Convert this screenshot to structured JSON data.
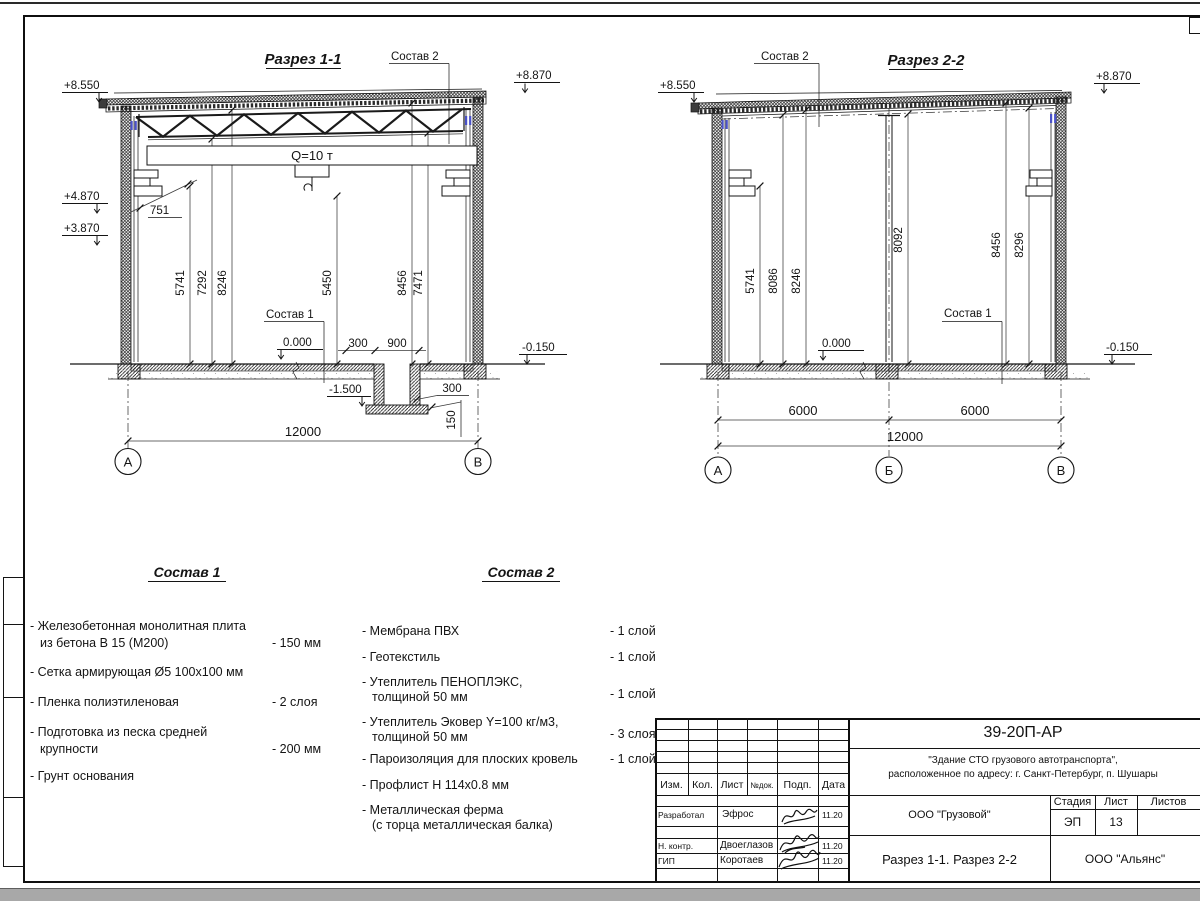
{
  "section1": {
    "title": "Разрез 1-1",
    "callout_roof": "Состав 2",
    "callout_floor": "Состав 1",
    "crane_capacity": "Q=10 т",
    "elev_roof_left": "+8.550",
    "elev_roof_right": "+8.870",
    "elev_console": "+4.870",
    "elev_rail": "+3.870",
    "elev_floor": "0.000",
    "elev_ground": "-0.150",
    "elev_pit": "-1.500",
    "dim_console": "751",
    "vdims": [
      "5741",
      "7292",
      "8246",
      "5450",
      "8456",
      "7471"
    ],
    "pit_offset": "300",
    "pit_width": "900",
    "pit_wall": "300",
    "pit_slab": "150",
    "span": "12000",
    "axis_a": "А",
    "axis_b": "В"
  },
  "section2": {
    "title": "Разрез 2-2",
    "callout_roof": "Состав 2",
    "callout_floor": "Состав 1",
    "elev_roof_left": "+8.550",
    "elev_roof_right": "+8.870",
    "elev_floor": "0.000",
    "elev_ground": "-0.150",
    "vdims": [
      "5741",
      "8086",
      "8246",
      "8092",
      "8456",
      "8296"
    ],
    "bay1": "6000",
    "bay2": "6000",
    "span": "12000",
    "axis_a": "А",
    "axis_b": "Б",
    "axis_c": "В"
  },
  "sostav1": {
    "title": "Состав 1",
    "items": [
      {
        "line1": "- Железобетонная монолитная плита",
        "line2": "из бетона В 15 (М200)",
        "value": "- 150 мм"
      },
      {
        "line1": "- Сетка армирующая Ø5 100х100 мм",
        "line2": "",
        "value": ""
      },
      {
        "line1": "- Пленка полиэтиленовая",
        "line2": "",
        "value": "- 2 слоя"
      },
      {
        "line1": "- Подготовка из песка средней",
        "line2": "крупности",
        "value": "- 200 мм"
      },
      {
        "line1": "- Грунт основания",
        "line2": "",
        "value": ""
      }
    ]
  },
  "sostav2": {
    "title": "Состав 2",
    "items": [
      {
        "line1": "- Мембрана ПВХ",
        "line2": "",
        "value": "- 1 слой"
      },
      {
        "line1": "- Геотекстиль",
        "line2": "",
        "value": "- 1 слой"
      },
      {
        "line1": "- Утеплитель ПЕНОПЛЭКС,",
        "line2": "толщиной 50 мм",
        "value": "- 1 слой"
      },
      {
        "line1": "- Утеплитель Эковер Y=100 кг/м3,",
        "line2": "толщиной 50 мм",
        "value": "- 3 слоя"
      },
      {
        "line1": "- Пароизоляция для плоских кровель",
        "line2": "",
        "value": "- 1 слой"
      },
      {
        "line1": "- Профлист Н 114х0.8 мм",
        "line2": "",
        "value": ""
      },
      {
        "line1": "- Металлическая ферма",
        "line2": "(с торца металлическая балка)",
        "value": ""
      }
    ]
  },
  "stamp": {
    "doc_number": "39-20П-АР",
    "project_line1": "\"Здание СТО грузового автотранспорта\",",
    "project_line2": "расположенное по адресу: г. Санкт-Петербург, п. Шушары",
    "col_izm": "Изм.",
    "col_kol": "Кол.",
    "col_list": "Лист",
    "col_ndok": "№док.",
    "col_podp": "Подп.",
    "col_data": "Дата",
    "row1_role": "Разработал",
    "row1_name": "Эфрос",
    "row1_date": "11.20",
    "row2_role": "Н. контр.",
    "row2_name": "Двоеглазов",
    "row2_date": "11.20",
    "row3_role": "ГИП",
    "row3_name": "Коротаев",
    "row3_date": "11.20",
    "client": "ООО \"Грузовой\"",
    "stage_label": "Стадия",
    "sheet_label": "Лист",
    "sheets_label": "Листов",
    "stage_value": "ЭП",
    "sheet_value": "13",
    "drawing_title": "Разрез 1-1. Разрез 2-2",
    "company": "ООО \"Альянс\""
  },
  "colors": {
    "line": "#141414",
    "blue_mark": "#4a52c8",
    "bottom_bar": "#a8a8a8"
  }
}
